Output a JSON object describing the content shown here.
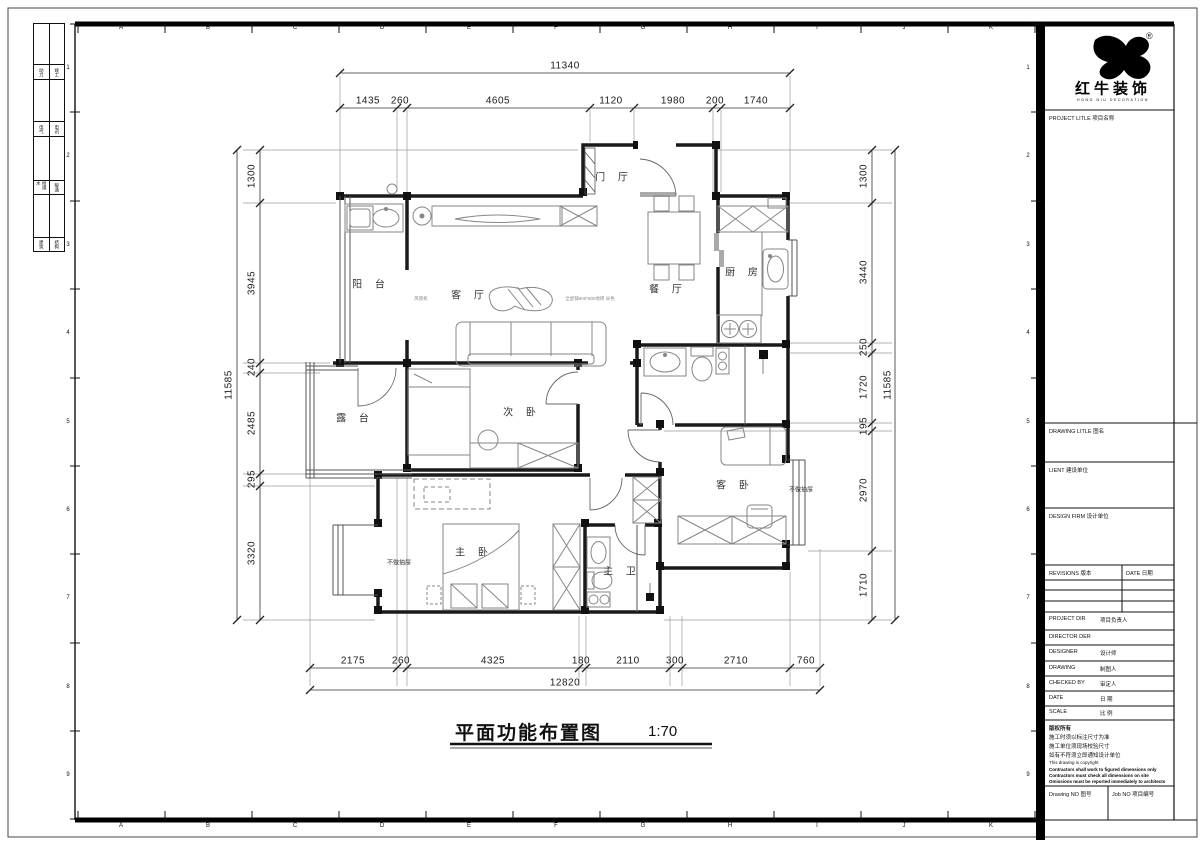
{
  "plan": {
    "title": "平面功能布置图",
    "scale_label": "1:70",
    "rooms": {
      "balcony": "阳 台",
      "living": "客 厅",
      "foyer": "门 厅",
      "dining": "餐 厅",
      "kitchen": "厨 房",
      "bedroom2": "次 卧",
      "terrace": "露 台",
      "guest": "客 卧",
      "master": "主 卧",
      "master_bath": "主 卫"
    },
    "notes": {
      "no_drawer_left": "不做抽屉",
      "no_drawer_right": "不做抽屉",
      "ac_unit": "风管机",
      "floor_tile": "全屋铺600*600地砖 米色"
    },
    "dims": {
      "top": {
        "total": "11340",
        "segs": [
          "1435",
          "260",
          "4605",
          "1120",
          "1980",
          "200",
          "1740"
        ]
      },
      "bottom": {
        "total": "12820",
        "segs": [
          "2175",
          "260",
          "4325",
          "180",
          "2110",
          "300",
          "2710",
          "760"
        ]
      },
      "left": {
        "total": "11585",
        "segs": [
          "1300",
          "3945",
          "240",
          "2485",
          "295",
          "3320"
        ]
      },
      "right": {
        "total": "11585",
        "segs": [
          "1300",
          "3440",
          "250",
          "1720",
          "195",
          "2970",
          "1710"
        ]
      }
    }
  },
  "frame": {
    "cols": [
      "A",
      "B",
      "C",
      "D",
      "E",
      "F",
      "G",
      "H",
      "I",
      "J",
      "K"
    ],
    "rows": [
      "1",
      "2",
      "3",
      "4",
      "5",
      "6",
      "7",
      "8",
      "9"
    ],
    "strip": [
      {
        "l": "动力",
        "r": "竣工"
      },
      {
        "l": "电气",
        "r": "电讯"
      },
      {
        "l": "给排水",
        "r": "暖通"
      },
      {
        "l": "建筑",
        "r": "结构"
      }
    ]
  },
  "title_block": {
    "logo": {
      "name": "红牛装饰",
      "sub": "HONG NIU DECORATION",
      "reg": "®"
    },
    "project_label": "PROJECT LITLE  项目名称",
    "drawing_label": "DRAWING LITLE  图名",
    "client_label": "LIENT  建设单位",
    "firm_label": "DESIGN FIRM  设计单位",
    "revisions_label": "REVISIONS  版本",
    "rev_date_label": "DATE  日期",
    "rows": [
      {
        "en": "PROJECT DIR",
        "cn": "项目负责人"
      },
      {
        "en": "DIRECTOR DER",
        "cn": ""
      },
      {
        "en": "DESIGNER",
        "cn": "设计师"
      },
      {
        "en": "DRAWING",
        "cn": "制图人"
      },
      {
        "en": "CHECKED BY",
        "cn": "审定人"
      },
      {
        "en": "DATE",
        "cn": "日  期"
      },
      {
        "en": "SCALE",
        "cn": "比  例"
      }
    ],
    "copyright": {
      "cn1": "版权所有",
      "cn2": "施工时须以标注尺寸为准",
      "cn3": "施工单位须现场校验尺寸",
      "cn4": "如有不符须立即通知设计单位",
      "en0": "This drawing is copyright",
      "en1": "Contractors shall work to figured dimensions only",
      "en2": "Contractors must check all dimensions on site",
      "en3": "Omissions must be reported immediately to architects"
    },
    "drawing_no_label": "Drawing NO  图号",
    "job_no_label": "Job NO  项目编号"
  }
}
